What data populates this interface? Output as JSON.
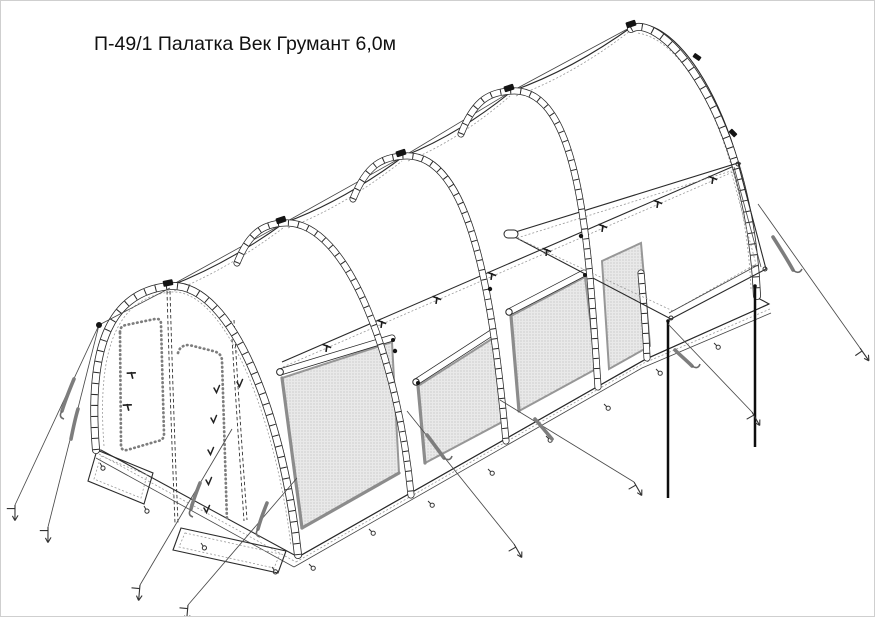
{
  "page": {
    "title": "П-49/1 Палатка Век Грумант 6,0м"
  },
  "palette": {
    "line": "#262626",
    "seam_dotted": "#999999",
    "mesh_fill": "#e9e9e9",
    "mesh_dot": "#ababab",
    "rope": "#4a4a4a",
    "pole": "#0d0d0d",
    "background": "#ffffff",
    "frame_border": "#cfcfcf"
  },
  "drawing": {
    "arch_count": 5,
    "mesh_panel_count": 4,
    "roll_bar_count": 3,
    "guy_rope_count": 8,
    "stake_count": 8,
    "awning_pole_count": 2
  }
}
